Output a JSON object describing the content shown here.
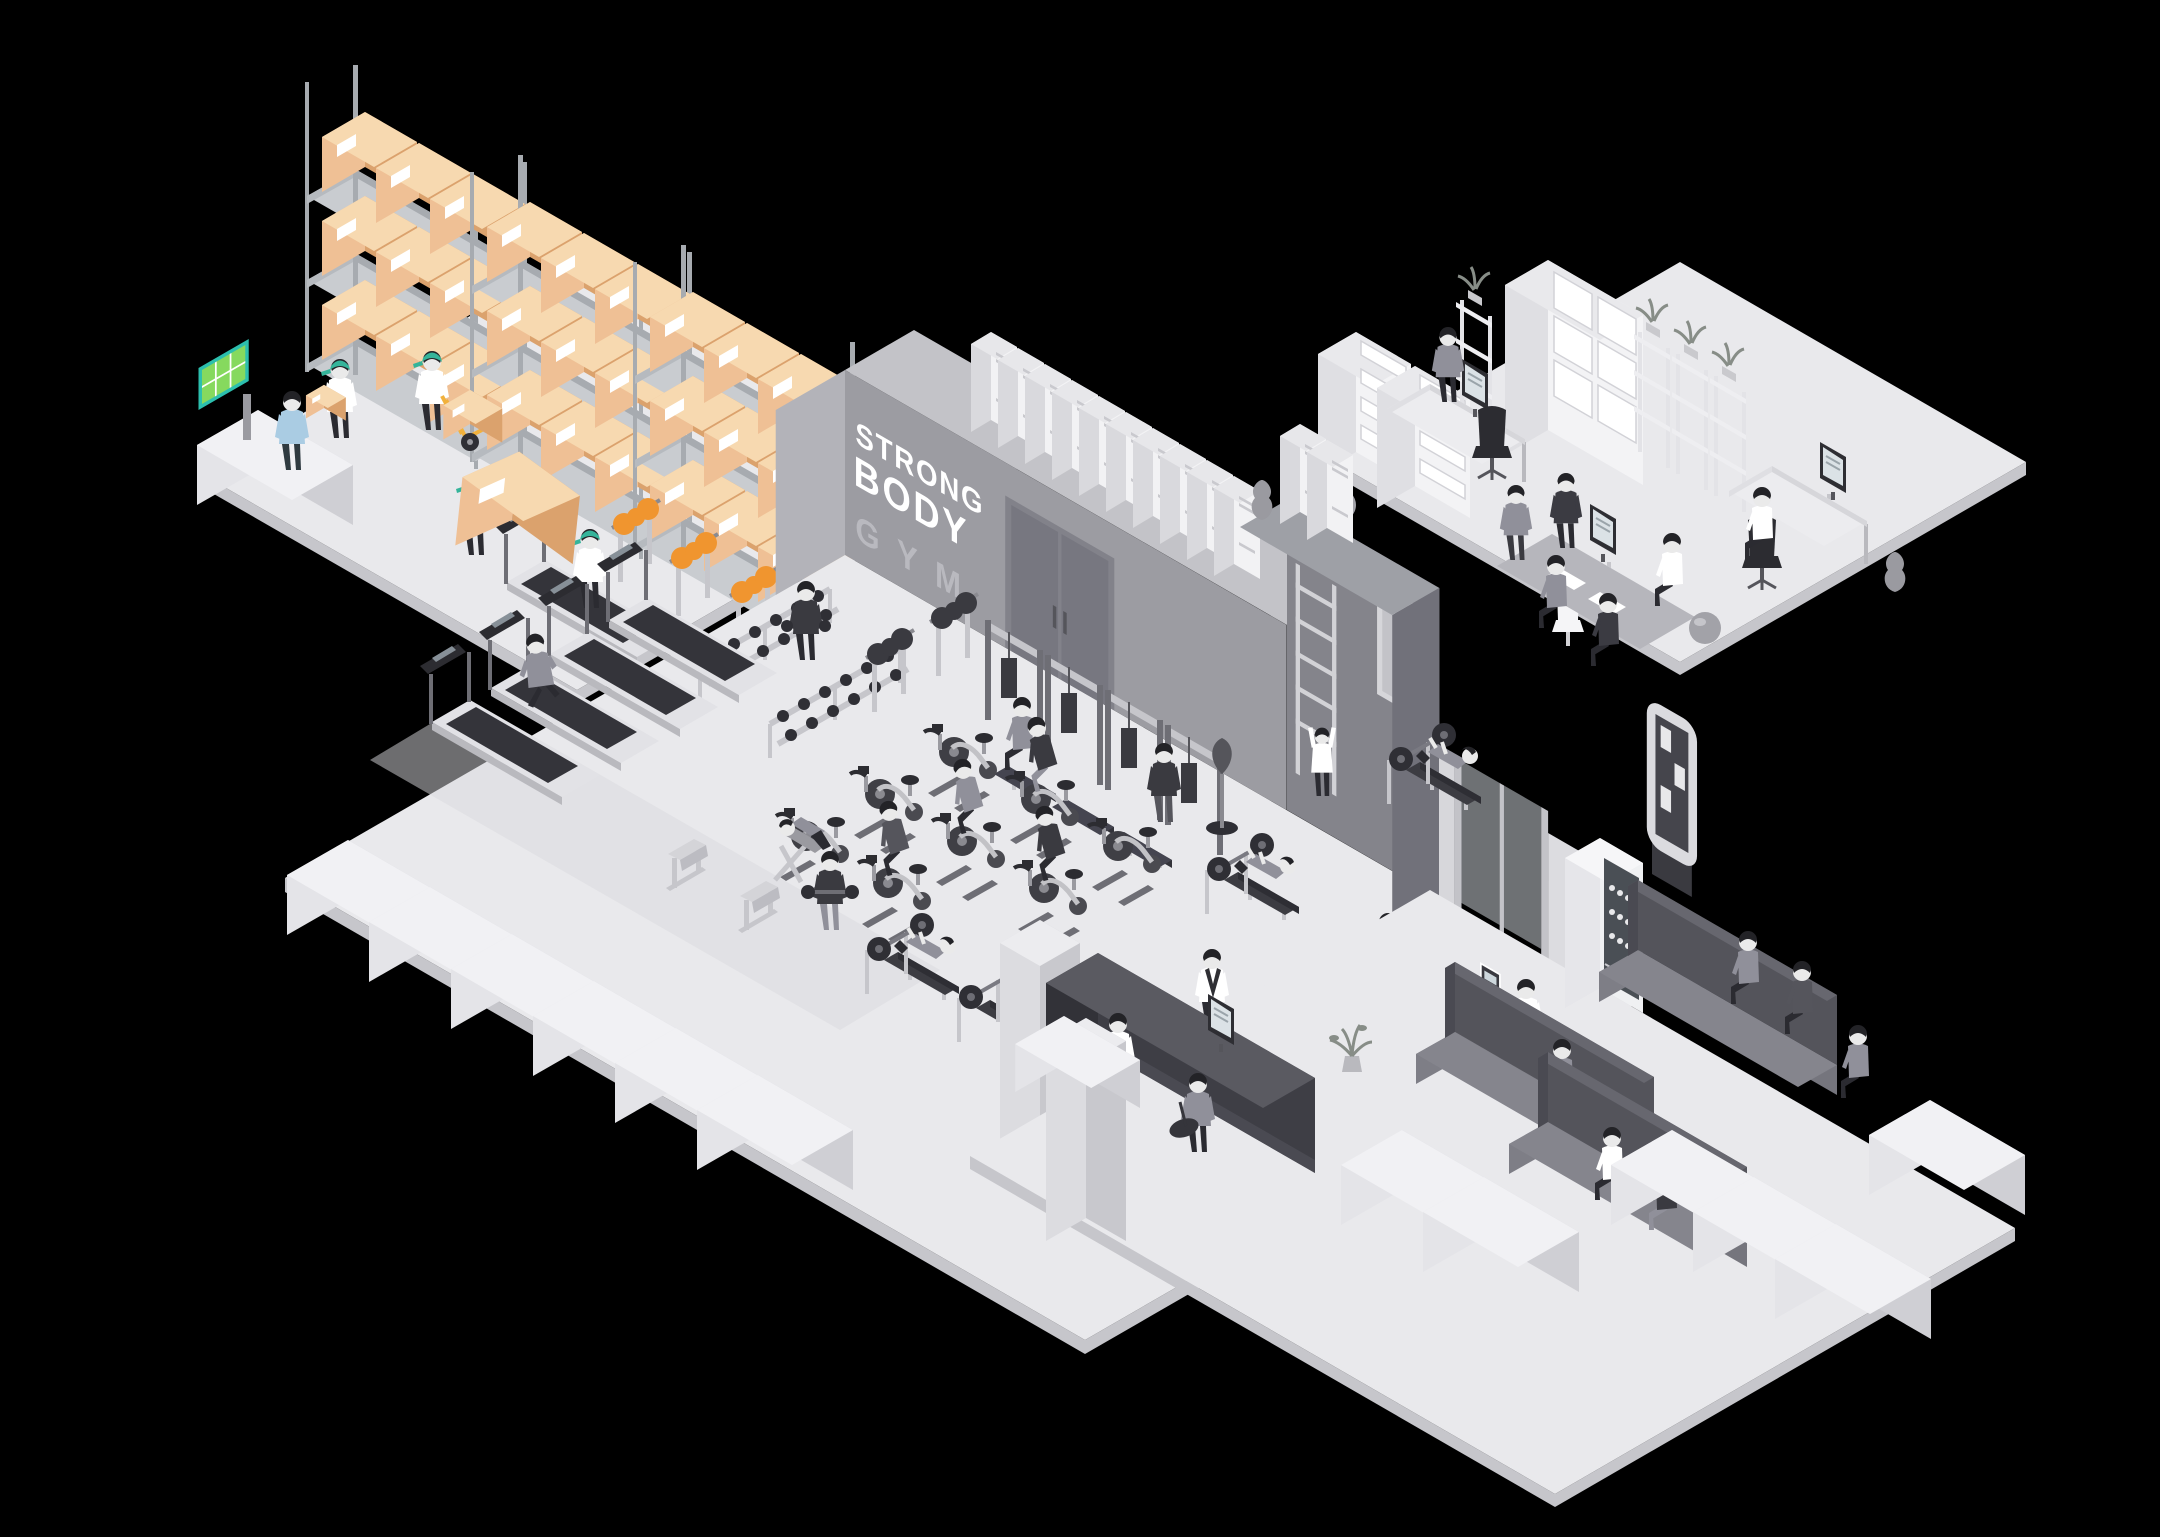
{
  "sign": {
    "line1": "STRONG",
    "line2": "BODY",
    "line3": "GYM"
  },
  "palette": {
    "bg": "#000000",
    "floor": "#e9e9ec",
    "floor_edge": "#c6c6cb",
    "shadow": "#d9d9de",
    "wall": "#9c9ca2",
    "wall_top": "#c3c3c8",
    "wall_cap": "#b3b3b9",
    "wall_dark": "#84848b",
    "wall_dark2": "#71717a",
    "door": "#82828a",
    "door_dark": "#777780",
    "locker": "#f2f2f4",
    "locker_side": "#d9d9dd",
    "locker_top": "#e7e7ea",
    "box_front": "#efc095",
    "box_side": "#dba26d",
    "box_top": "#f7d9b0",
    "shelf_frame": "#a7abb0",
    "shelf_slab": "#c9ccd0",
    "cap": "#35b49a",
    "truck": "#f1b13c",
    "screen": "#86d95e",
    "screen_frame": "#2cbfae",
    "plate_orange": "#f0952f",
    "eq_dark": "#2f2f35",
    "eq_mid": "#6e6e75",
    "eq_light": "#c6c6cb",
    "eq_lighter": "#e2e2e6",
    "bench_seat": "#75757d",
    "bench_seat_top": "#85858d",
    "bench_back": "#54545b",
    "bench_back_top": "#67676f",
    "block_l": "#e4e4e8",
    "block_r": "#cfcfd4",
    "block_t": "#f1f1f4",
    "counter_front": "#3e3e45",
    "counter_top": "#5a5a61",
    "counter_side": "#323238",
    "skin": "#eaeaea",
    "hair": "#232327",
    "white": "#ffffff",
    "suit": "#3b3b42",
    "gray_wear": "#90909a",
    "pants": "#2b2b31",
    "blue": "#aacce3",
    "glass": "#c9cdd3",
    "plant": "#878d87",
    "ball": "#a2a2a8",
    "vase": "#9a9aa0"
  }
}
